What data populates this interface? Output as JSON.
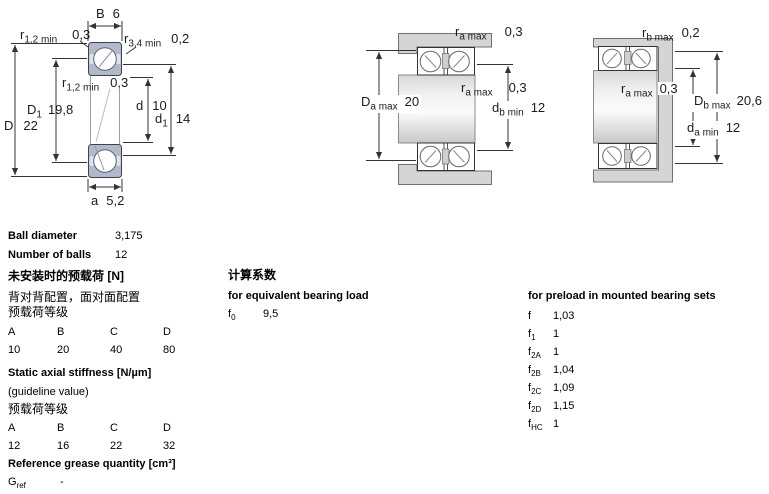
{
  "dims": {
    "single": {
      "B": {
        "base": "B",
        "sub": "",
        "value": "6"
      },
      "r12top": {
        "base": "r",
        "sub": "1,2 min",
        "value": "0,3"
      },
      "r34": {
        "base": "r",
        "sub": "3,4 min",
        "value": "0,2"
      },
      "r12mid": {
        "base": "r",
        "sub": "1,2 min",
        "value": "0,3"
      },
      "D1": {
        "base": "D",
        "sub": "1",
        "value": "19,8"
      },
      "D": {
        "base": "D",
        "sub": "",
        "value": "22"
      },
      "d": {
        "base": "d",
        "sub": "",
        "value": "10"
      },
      "d1": {
        "base": "d",
        "sub": "1",
        "value": "14"
      },
      "a": {
        "base": "a",
        "sub": "",
        "value": "5,2"
      }
    },
    "pairLeft": {
      "raTop": {
        "base": "r",
        "sub": "a max",
        "value": "0,3"
      },
      "raMid": {
        "base": "r",
        "sub": "a max",
        "value": "0,3"
      },
      "Da": {
        "base": "D",
        "sub": "a max",
        "value": "20"
      },
      "db": {
        "base": "d",
        "sub": "b min",
        "value": "12"
      }
    },
    "pairRight": {
      "rbTop": {
        "base": "r",
        "sub": "b max",
        "value": "0,2"
      },
      "raMid": {
        "base": "r",
        "sub": "a max",
        "value": "0,3"
      },
      "Db": {
        "base": "D",
        "sub": "b max",
        "value": "20,6"
      },
      "da": {
        "base": "d",
        "sub": "a min",
        "value": "12"
      }
    }
  },
  "specs": {
    "ball_diameter_label": "Ball diameter",
    "ball_diameter_value": "3,175",
    "number_of_balls_label": "Number of balls",
    "number_of_balls_value": "12",
    "preload_unmounted": {
      "title": "未安装时的预载荷 [N]",
      "subtitle": "背对背配置，面对面配置",
      "class_label": "预载荷等级",
      "headers": [
        "A",
        "B",
        "C",
        "D"
      ],
      "values": [
        "10",
        "20",
        "40",
        "80"
      ]
    },
    "stiffness": {
      "title": "Static axial stiffness [N/µm]",
      "subtitle": "(guideline value)",
      "class_label": "预载荷等级",
      "headers": [
        "A",
        "B",
        "C",
        "D"
      ],
      "values": [
        "12",
        "16",
        "22",
        "32"
      ]
    },
    "grease": {
      "title": "Reference grease quantity [cm³]",
      "symbol_base": "G",
      "symbol_sub": "ref",
      "value": "-"
    }
  },
  "factors": {
    "title_cn": "计算系数",
    "equiv_title": "for equivalent bearing load",
    "f0": {
      "base": "f",
      "sub": "0",
      "value": "9,5"
    },
    "preload_title": "for preload in mounted bearing sets",
    "preload_rows": [
      {
        "base": "f",
        "sub": "",
        "value": "1,03"
      },
      {
        "base": "f",
        "sub": "1",
        "value": "1"
      },
      {
        "base": "f",
        "sub": "2A",
        "value": "1"
      },
      {
        "base": "f",
        "sub": "2B",
        "value": "1,04"
      },
      {
        "base": "f",
        "sub": "2C",
        "value": "1,09"
      },
      {
        "base": "f",
        "sub": "2D",
        "value": "1,15"
      },
      {
        "base": "f",
        "sub": "HC",
        "value": "1"
      }
    ]
  },
  "colors": {
    "ring_fill": "#b2bac9",
    "metal_gray": "#d5d5d5",
    "line": "#333333"
  }
}
